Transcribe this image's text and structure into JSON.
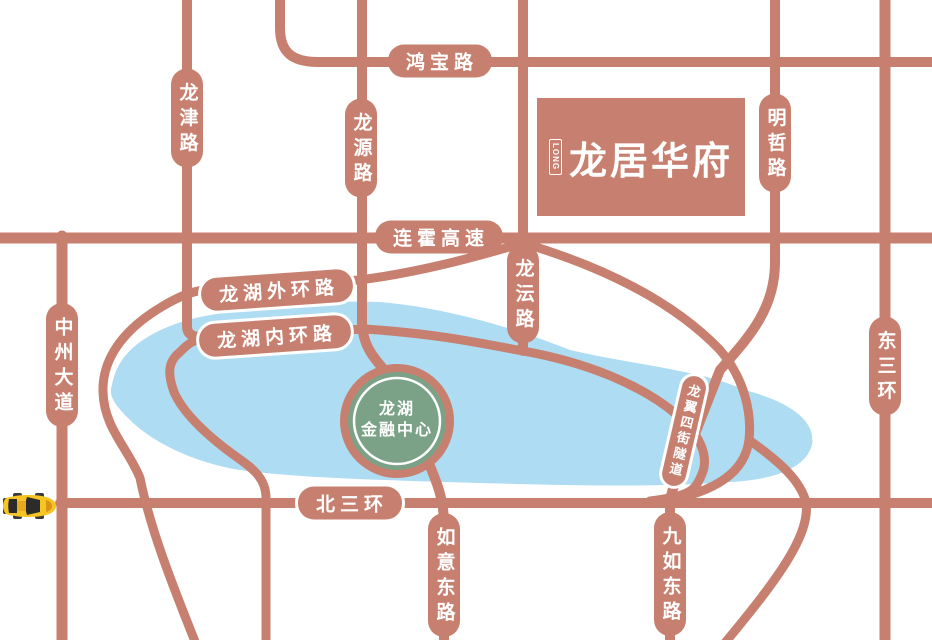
{
  "map": {
    "logo": {
      "name": "龙居华府",
      "mark": "LONG"
    },
    "landmark": {
      "line1": "龙湖",
      "line2": "金融中心"
    },
    "roads": {
      "hongbao": "鸿宝路",
      "longjin": "龙津路",
      "longyuan": "龙源路",
      "mingzhe": "明哲路",
      "lianhuo": "连霍高速",
      "longhu_outer": "龙湖外环路",
      "longhu_inner": "龙湖内环路",
      "longyun": "龙沄路",
      "zhongzhou": "中州大道",
      "dongsanhuan": "东三环",
      "beisanhuan": "北三环",
      "ruyi": "如意东路",
      "jiuru": "九如东路",
      "longyi_tunnel": "龙翼四街隧道"
    },
    "colors": {
      "road": "#c7806f",
      "lake": "#aedcf2",
      "landmark_green": "#7ba287",
      "landmark_ring": "#ffffff",
      "car_body": "#f6c423",
      "label_text": "#ffffff",
      "background": "#ffffff"
    }
  }
}
